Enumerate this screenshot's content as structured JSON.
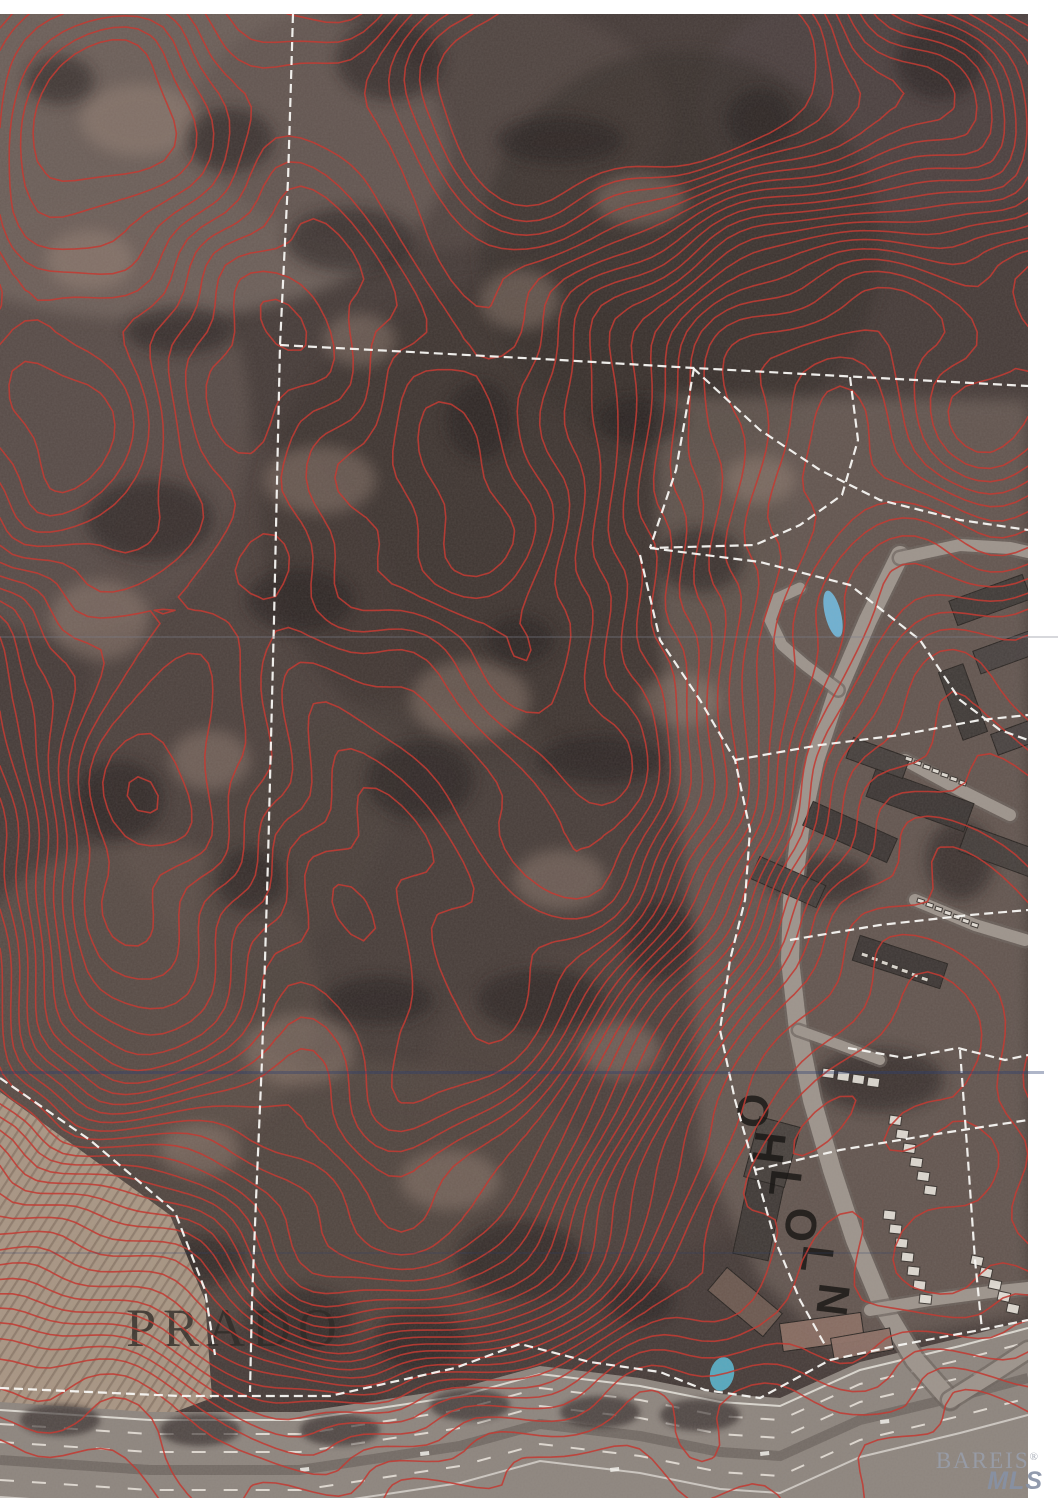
{
  "map": {
    "labels": {
      "area": "PRADO",
      "street_vertical": "OHLO LN"
    },
    "watermark": {
      "brand": "BAREIS",
      "registered": "®",
      "mls": "MLS"
    },
    "colors": {
      "contour_red": "#c23b33",
      "parcel_line_white": "#f8f7f3",
      "pool_blue": "#6fb6d9",
      "terrain_dark": "#453b38",
      "clearing_light": "#a18a7d",
      "road_gray": "#9d948c",
      "freeway_gray": "#8d857e",
      "scan_margin_white": "#ffffff",
      "label_dark": "#33302c"
    }
  }
}
